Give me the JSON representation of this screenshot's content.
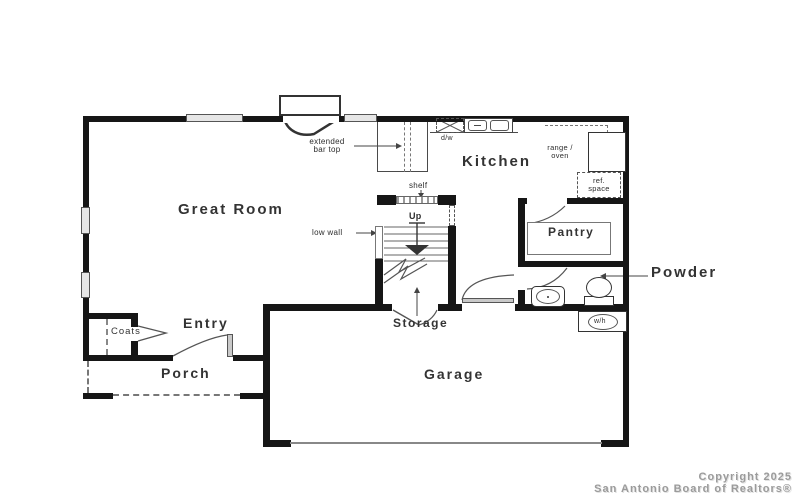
{
  "plan": {
    "title_hint": "single family first-floor plan",
    "colors": {
      "wall": "#161616",
      "line": "#4a4a4a",
      "window": "#e6e6e6",
      "copyright_gray": "#9b9b9b"
    },
    "rooms": {
      "great_room": "Great Room",
      "kitchen": "Kitchen",
      "pantry": "Pantry",
      "powder": "Powder",
      "entry": "Entry",
      "porch": "Porch",
      "garage": "Garage",
      "storage": "Storage",
      "coats": "Coats"
    },
    "annotations": {
      "extended_bar_top_line1": "extended",
      "extended_bar_top_line2": "bar top",
      "dishwasher": "d/w",
      "range_oven_line1": "range /",
      "range_oven_line2": "oven",
      "ref_space_line1": "ref.",
      "ref_space_line2": "space",
      "shelf": "shelf",
      "up": "Up",
      "low_wall": "low wall",
      "water_heater": "w/h"
    }
  },
  "footer": {
    "copyright_line1": "Copyright 2025",
    "copyright_line2": "San Antonio Board of Realtors®"
  }
}
